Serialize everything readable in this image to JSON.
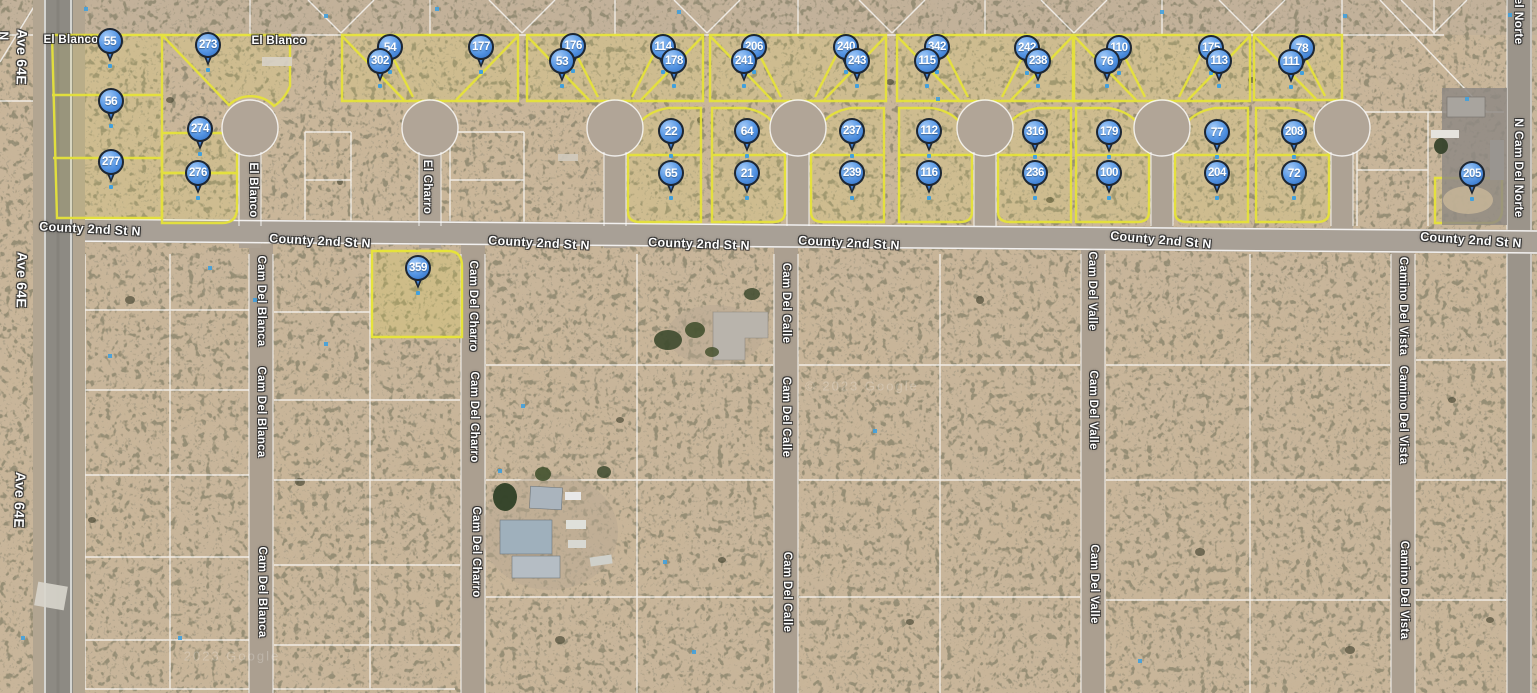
{
  "map": {
    "attribution": "© 2023 Google",
    "colors": {
      "parcel_outline": "#e6e33a",
      "pin_fill": "#4a8edd",
      "pin_border": "#1d2632",
      "road_line": "#ffffff",
      "label_text": "#ffffff",
      "survey_dot": "#41a0dd"
    }
  },
  "pins": [
    {
      "label": "55",
      "x": 110,
      "y": 41
    },
    {
      "label": "273",
      "x": 208,
      "y": 45
    },
    {
      "label": "176",
      "x": 573,
      "y": 46
    },
    {
      "label": "54",
      "x": 390,
      "y": 47
    },
    {
      "label": "177",
      "x": 481,
      "y": 47
    },
    {
      "label": "114",
      "x": 663,
      "y": 47
    },
    {
      "label": "206",
      "x": 754,
      "y": 47
    },
    {
      "label": "240",
      "x": 846,
      "y": 47
    },
    {
      "label": "342",
      "x": 937,
      "y": 47
    },
    {
      "label": "242",
      "x": 1027,
      "y": 48
    },
    {
      "label": "110",
      "x": 1119,
      "y": 48
    },
    {
      "label": "175",
      "x": 1211,
      "y": 48
    },
    {
      "label": "78",
      "x": 1302,
      "y": 48
    },
    {
      "label": "302",
      "x": 380,
      "y": 61
    },
    {
      "label": "53",
      "x": 562,
      "y": 61
    },
    {
      "label": "178",
      "x": 674,
      "y": 61
    },
    {
      "label": "241",
      "x": 744,
      "y": 61
    },
    {
      "label": "243",
      "x": 857,
      "y": 61
    },
    {
      "label": "115",
      "x": 927,
      "y": 61
    },
    {
      "label": "238",
      "x": 1038,
      "y": 61
    },
    {
      "label": "76",
      "x": 1107,
      "y": 61
    },
    {
      "label": "113",
      "x": 1219,
      "y": 61
    },
    {
      "label": "111",
      "x": 1291,
      "y": 62
    },
    {
      "label": "56",
      "x": 111,
      "y": 101
    },
    {
      "label": "274",
      "x": 200,
      "y": 129
    },
    {
      "label": "22",
      "x": 671,
      "y": 131
    },
    {
      "label": "64",
      "x": 747,
      "y": 131
    },
    {
      "label": "237",
      "x": 852,
      "y": 131
    },
    {
      "label": "112",
      "x": 929,
      "y": 131
    },
    {
      "label": "316",
      "x": 1035,
      "y": 132
    },
    {
      "label": "179",
      "x": 1109,
      "y": 132
    },
    {
      "label": "77",
      "x": 1217,
      "y": 132
    },
    {
      "label": "208",
      "x": 1294,
      "y": 132
    },
    {
      "label": "277",
      "x": 111,
      "y": 162
    },
    {
      "label": "276",
      "x": 198,
      "y": 173
    },
    {
      "label": "65",
      "x": 671,
      "y": 173
    },
    {
      "label": "21",
      "x": 747,
      "y": 173
    },
    {
      "label": "239",
      "x": 852,
      "y": 173
    },
    {
      "label": "116",
      "x": 929,
      "y": 173
    },
    {
      "label": "236",
      "x": 1035,
      "y": 173
    },
    {
      "label": "100",
      "x": 1109,
      "y": 173
    },
    {
      "label": "204",
      "x": 1217,
      "y": 173
    },
    {
      "label": "72",
      "x": 1294,
      "y": 173
    },
    {
      "label": "205",
      "x": 1472,
      "y": 174
    },
    {
      "label": "359",
      "x": 418,
      "y": 268
    }
  ],
  "street_labels": [
    {
      "text": "El Blanco",
      "x": 71,
      "y": 40,
      "rot": 0,
      "size": 11.5
    },
    {
      "text": "El Blanco",
      "x": 279,
      "y": 41,
      "rot": 0,
      "size": 11.5
    },
    {
      "text": "County 2nd St N",
      "x": 90,
      "y": 229,
      "rot": 3,
      "size": 12.5
    },
    {
      "text": "County 2nd St N",
      "x": 320,
      "y": 241,
      "rot": 3,
      "size": 12.5
    },
    {
      "text": "County 2nd St N",
      "x": 539,
      "y": 243,
      "rot": 3,
      "size": 12.5
    },
    {
      "text": "County 2nd St N",
      "x": 699,
      "y": 244,
      "rot": 2,
      "size": 12.5
    },
    {
      "text": "County 2nd St N",
      "x": 849,
      "y": 243,
      "rot": 3,
      "size": 12.5
    },
    {
      "text": "County 2nd St N",
      "x": 1161,
      "y": 240,
      "rot": 5,
      "size": 12.5
    },
    {
      "text": "County 2nd St N",
      "x": 1471,
      "y": 240,
      "rot": 4,
      "size": 12.5
    },
    {
      "text": "N",
      "x": 4,
      "y": 36,
      "rot": 90,
      "size": 12
    },
    {
      "text": "Ave 64E",
      "x": 22,
      "y": 57,
      "rot": 91,
      "size": 14
    },
    {
      "text": "Ave 64E",
      "x": 22,
      "y": 280,
      "rot": 91,
      "size": 14
    },
    {
      "text": "Ave 64E",
      "x": 20,
      "y": 500,
      "rot": 92,
      "size": 14
    },
    {
      "text": "El Blanco",
      "x": 253,
      "y": 190,
      "rot": 90,
      "size": 11.5
    },
    {
      "text": "El Charro",
      "x": 427,
      "y": 187,
      "rot": 90,
      "size": 11.5
    },
    {
      "text": "Cam Del Blanca",
      "x": 261,
      "y": 301,
      "rot": 90,
      "size": 11.5
    },
    {
      "text": "Cam Del Blanca",
      "x": 261,
      "y": 412,
      "rot": 90,
      "size": 11.5
    },
    {
      "text": "Cam Del Blanca",
      "x": 262,
      "y": 592,
      "rot": 90,
      "size": 11.5
    },
    {
      "text": "Cam Del Charro",
      "x": 473,
      "y": 306,
      "rot": 90,
      "size": 11.5
    },
    {
      "text": "Cam Del Charro",
      "x": 474,
      "y": 417,
      "rot": 90,
      "size": 11.5
    },
    {
      "text": "Cam Del Charro",
      "x": 476,
      "y": 552,
      "rot": 90,
      "size": 11.5
    },
    {
      "text": "Cam Del Calle",
      "x": 786,
      "y": 303,
      "rot": 90,
      "size": 11.5
    },
    {
      "text": "Cam Del Calle",
      "x": 786,
      "y": 417,
      "rot": 90,
      "size": 11.5
    },
    {
      "text": "Cam Del Calle",
      "x": 787,
      "y": 592,
      "rot": 90,
      "size": 11.5
    },
    {
      "text": "Cam Del Valle",
      "x": 1092,
      "y": 291,
      "rot": 90,
      "size": 11.5
    },
    {
      "text": "Cam Del Valle",
      "x": 1093,
      "y": 410,
      "rot": 90,
      "size": 11.5
    },
    {
      "text": "Cam Del Valle",
      "x": 1094,
      "y": 584,
      "rot": 90,
      "size": 11.5
    },
    {
      "text": "Camino Del Vista",
      "x": 1403,
      "y": 306,
      "rot": 90,
      "size": 11.5
    },
    {
      "text": "Camino Del Vista",
      "x": 1403,
      "y": 415,
      "rot": 90,
      "size": 11.5
    },
    {
      "text": "Camino Del Vista",
      "x": 1404,
      "y": 590,
      "rot": 90,
      "size": 11.5
    },
    {
      "text": "el Norte",
      "x": 1519,
      "y": 21,
      "rot": 90,
      "size": 12
    },
    {
      "text": "N Cam Del Norte",
      "x": 1519,
      "y": 168,
      "rot": 90,
      "size": 12
    }
  ],
  "watermarks": [
    {
      "text": "© 2023 Google",
      "x": 862,
      "y": 386
    },
    {
      "text": "2023 Google",
      "x": 232,
      "y": 656
    }
  ]
}
